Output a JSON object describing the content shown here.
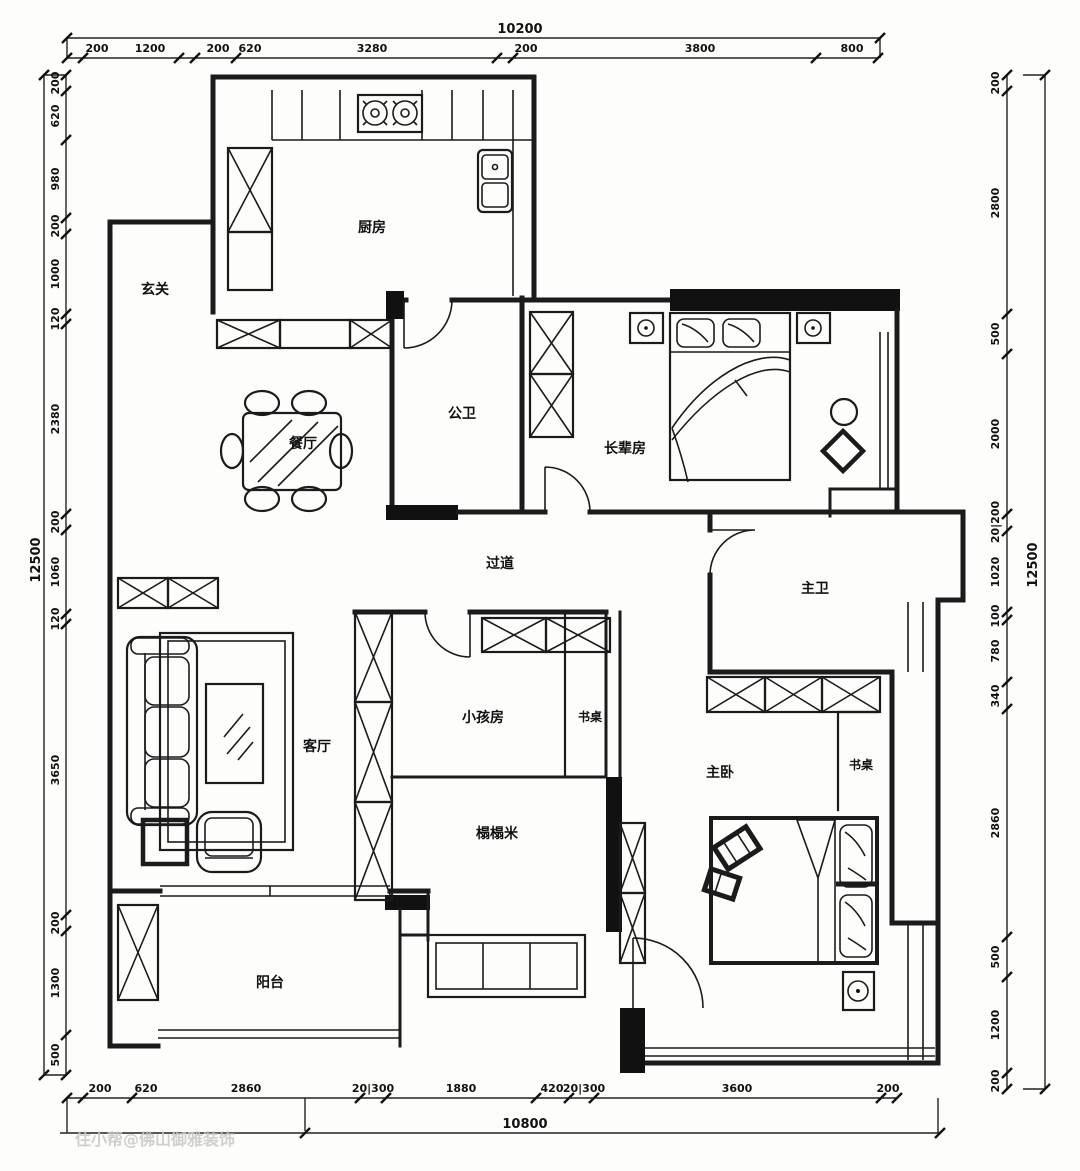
{
  "watermark": "住小帮@佛山御雅装饰",
  "rooms": {
    "kitchen": "厨房",
    "entry": "玄关",
    "public_bath": "公卫",
    "elders": "长辈房",
    "dining": "餐厅",
    "hallway": "过道",
    "master_bath": "主卫",
    "kids": "小孩房",
    "kids_desk": "书桌",
    "living": "客厅",
    "tatami": "榻榻米",
    "master": "主卧",
    "master_desk": "书桌",
    "balcony": "阳台"
  },
  "dims": {
    "top": {
      "total": "10200",
      "segments": [
        "200",
        "1200",
        "200",
        "620",
        "3280",
        "200",
        "3800",
        "800"
      ]
    },
    "bottom": {
      "total": "10800",
      "segments": [
        "200",
        "620",
        "2860",
        "20|300",
        "1880",
        "420",
        "20|300",
        "3600",
        "200"
      ]
    },
    "left": {
      "total": "12500",
      "segments": [
        "200",
        "620",
        "980",
        "200",
        "1000",
        "120",
        "2380",
        "200",
        "1060",
        "120",
        "3650",
        "200",
        "1300",
        "500"
      ]
    },
    "right": {
      "total": "12500",
      "segments": [
        "200",
        "2800",
        "500",
        "2000",
        "20|200",
        "1020",
        "100",
        "780",
        "340",
        "2860",
        "500",
        "1200",
        "200"
      ]
    }
  },
  "colors": {
    "line": "#1b1b1b",
    "background": "#fdfdfc",
    "watermark": "#c8c8c6"
  }
}
